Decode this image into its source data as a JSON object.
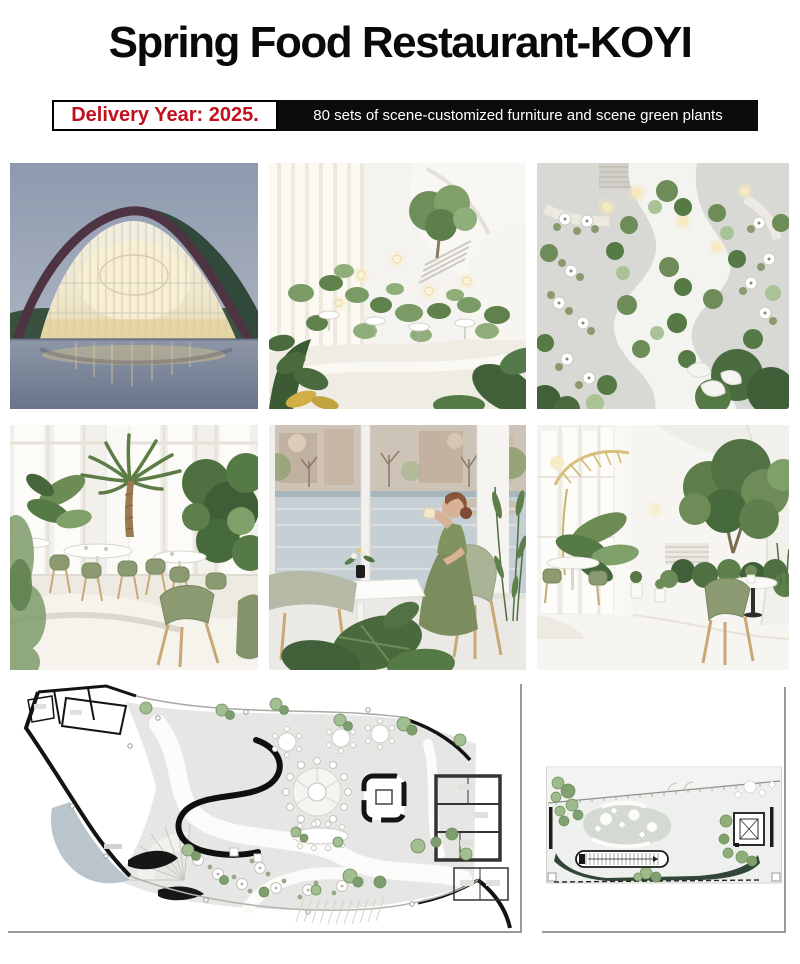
{
  "header": {
    "title": "Spring Food Restaurant-KOYI",
    "delivery_badge": {
      "label": "Delivery Year: 2025.",
      "text_color": "#c3101e",
      "border_color": "#000000",
      "background": "#ffffff"
    },
    "info_banner": {
      "label": "80 sets of scene-customized furniture and scene green plants",
      "background": "#0c0c0c",
      "text_color": "#ffffff"
    }
  },
  "gallery": {
    "rows": 2,
    "columns": 3,
    "photos": [
      {
        "id": "exterior-dusk",
        "label": "curved-roof restaurant building over water at dusk"
      },
      {
        "id": "atrium-garden",
        "label": "white atrium with indoor garden and cafe tables"
      },
      {
        "id": "winding-path",
        "label": "winding white path through planted dining hall"
      },
      {
        "id": "palm-dining",
        "label": "dining area with olive chairs and palm tree"
      },
      {
        "id": "window-guest",
        "label": "guest drinking by lake-view window"
      },
      {
        "id": "tree-lounge",
        "label": "lounge with large indoor tree and staircase"
      }
    ]
  },
  "plans": {
    "ground_floor": {
      "id": "ground-floor-plan",
      "label": "ground floor furniture plan"
    },
    "upper_floor": {
      "id": "upper-floor-plan",
      "label": "upper floor furniture plan"
    }
  },
  "palette": {
    "accent_red": "#c3101e",
    "banner_black": "#0c0c0c",
    "chair_olive": "#8b9a70",
    "plant_green": "#6d8c58",
    "plan_water": "#b9c5cb",
    "frame_gray": "#9a9a9a"
  }
}
